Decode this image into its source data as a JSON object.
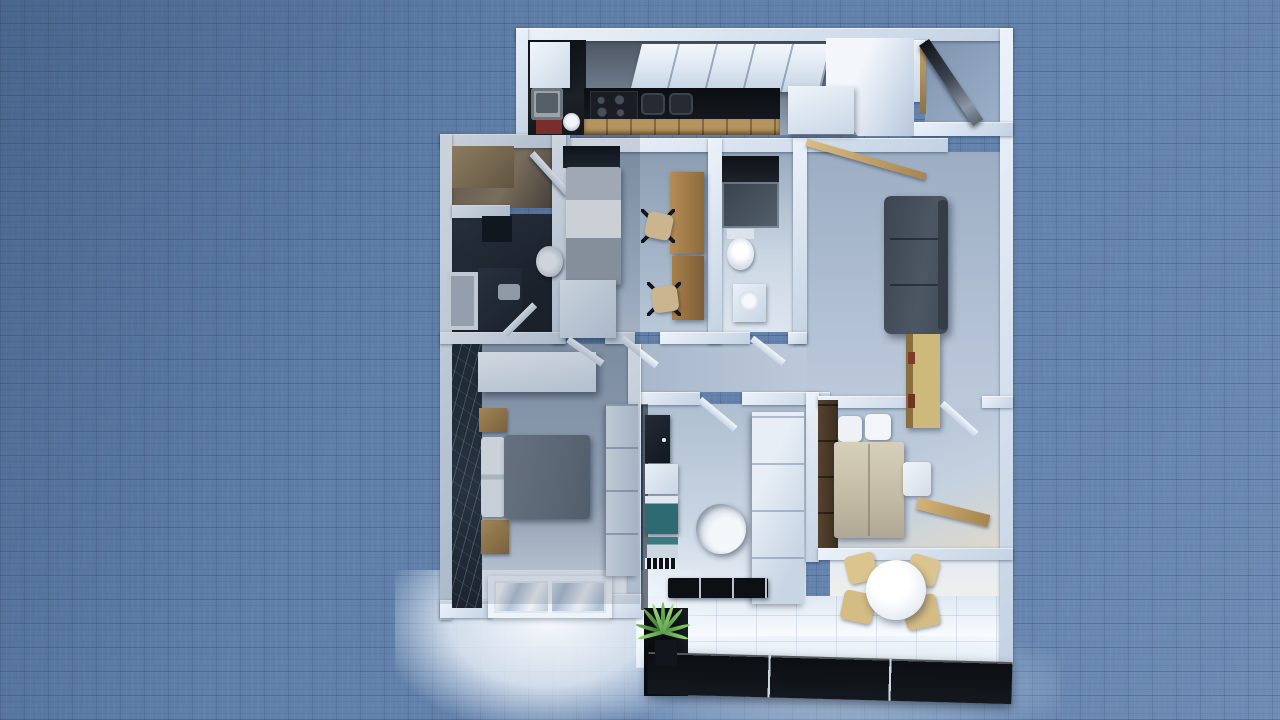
{
  "scene": {
    "app": "3D home-design viewport",
    "view": "top-down aerial render of a furnished apartment on a blueprint grid",
    "canvas": {
      "width_px": 1280,
      "height_px": 720,
      "grid_cell_px": 24
    },
    "palette": {
      "canvas_background": "#6080aa",
      "grid_line": "#4e6f9c",
      "wall": "#cfdded",
      "wall_highlight": "#edf3fa",
      "counter_black": "#0c0f13",
      "wood_light": "#c8a76a",
      "wood_desk": "#a87f4a",
      "wood_dark": "#4a392b",
      "sofa_gray": "#46505c",
      "washer_teal": "#2e6a72",
      "accent_wall_dark": "#232c38",
      "glazing_black": "#0b0e12",
      "plant_green": "#5aa344",
      "window_light": "#f6fafe",
      "duvet_gray": "#6f7a88",
      "bed_beige": "#cfc6b0"
    },
    "rooms": [
      {
        "id": "kitchen",
        "label": "Kitchen",
        "furniture": [
          "sink",
          "cooktop",
          "black countertop",
          "upper cabinets",
          "tall cabinet / fridge",
          "base cabinets"
        ]
      },
      {
        "id": "entry",
        "label": "Entry",
        "furniture": [
          "open front door"
        ]
      },
      {
        "id": "living-room",
        "label": "Living room",
        "furniture": [
          "gray sofa",
          "sideboard with books",
          "wall plank shelf"
        ]
      },
      {
        "id": "closet",
        "label": "Storage closet",
        "furniture": [
          "open wardrobe shelving"
        ]
      },
      {
        "id": "bathroom-1",
        "label": "Bathroom 1 (dark)",
        "furniture": [
          "toilet",
          "shower tray",
          "dark vanity",
          "washbasin"
        ]
      },
      {
        "id": "bedroom-1",
        "label": "Bedroom 1 (single)",
        "furniture": [
          "single bed",
          "dark headboard",
          "wooden desk",
          "desk chair",
          "desk chair",
          "white wardrobe"
        ]
      },
      {
        "id": "bathroom-2",
        "label": "Bathroom 2",
        "furniture": [
          "dark shower",
          "toilet",
          "washbasin vanity"
        ]
      },
      {
        "id": "hallway",
        "label": "Hallway",
        "furniture": [
          "open doors"
        ]
      },
      {
        "id": "master-bedroom",
        "label": "Master bedroom",
        "furniture": [
          "double bed",
          "nightstand",
          "nightstand",
          "floating shelf",
          "tall wardrobe",
          "dark accent wall",
          "window"
        ]
      },
      {
        "id": "bathroom-3",
        "label": "Bathroom 3",
        "furniture": [
          "mirror cabinet",
          "vanity",
          "washing machine",
          "round bathtub",
          "storage column",
          "radiator grate",
          "black bath mat"
        ]
      },
      {
        "id": "bedroom-2",
        "label": "Bedroom 2 (double)",
        "furniture": [
          "double bed",
          "dark wardrobe",
          "white bench",
          "wall shelf"
        ]
      },
      {
        "id": "dining",
        "label": "Dining corner",
        "furniture": [
          "round white table",
          "wooden chair",
          "wooden chair",
          "wooden chair",
          "wooden chair"
        ]
      },
      {
        "id": "balcony",
        "label": "Balcony / glazed wall",
        "furniture": [
          "black window wall",
          "potted plant"
        ]
      }
    ]
  }
}
